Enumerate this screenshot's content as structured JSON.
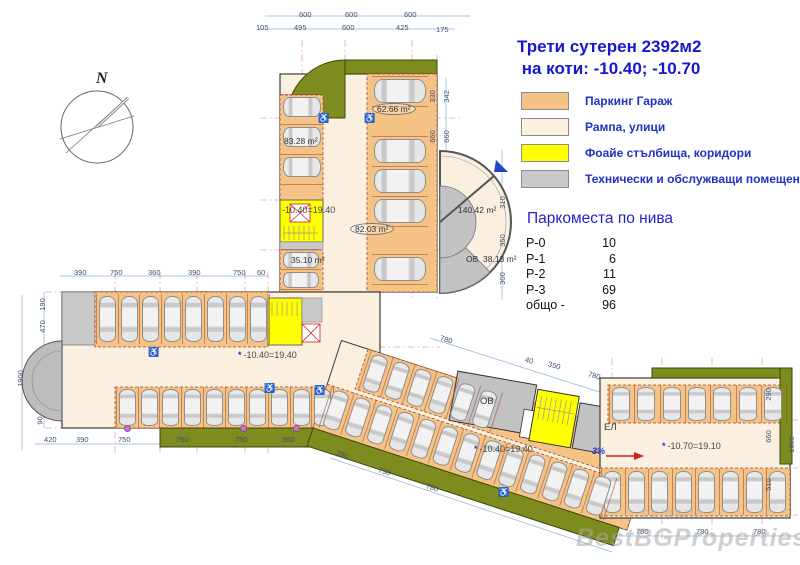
{
  "title": {
    "line1": "Трети сутерен 2392м2",
    "line2": " на коти: -10.40; -10.70"
  },
  "legend": {
    "items": [
      {
        "label": "Паркинг Гараж",
        "color": "#F6C387"
      },
      {
        "label": "Рампа, улици",
        "color": "#FCF1E3"
      },
      {
        "label": "Фоайе стълбища, коридори",
        "color": "#FFFF00"
      },
      {
        "label": "Технически и обслужващи помещения",
        "color": "#C9C9C9"
      }
    ]
  },
  "parking_table": {
    "title": "Паркоместа по нива",
    "rows": [
      {
        "level": "Р-0",
        "count": "10"
      },
      {
        "level": "Р-1",
        "count": "6"
      },
      {
        "level": "Р-2",
        "count": "11"
      },
      {
        "level": "Р-3",
        "count": "69"
      },
      {
        "level": "общо -",
        "count": "96"
      }
    ]
  },
  "compass": {
    "label": "N"
  },
  "plan": {
    "area_labels": {
      "a83": "83.28 m²",
      "a62": "62.66 m²",
      "a82": "82.03 m²",
      "a35": "35.10 m²",
      "a140": "140.42 m²",
      "a38": "38.13 m²"
    },
    "level_labels": {
      "top": "-10.40=19.40",
      "left": "-10.40=19.40",
      "mid": "-10.40=19.40",
      "right": "-10.70=19.10"
    },
    "rooms": {
      "ov_circle": "ОВ",
      "ov_mid": "ОВ",
      "el": "ЕЛ"
    },
    "slope": "3%"
  },
  "dimensions": {
    "top_row1": [
      "600",
      "600",
      "600"
    ],
    "top_row2": [
      "105",
      "495",
      "600",
      "425",
      "175"
    ],
    "vwing_right": [
      "330",
      "342",
      "660",
      "660",
      "310",
      "350",
      "300"
    ],
    "leftwing_top": [
      "390",
      "750",
      "360",
      "390",
      "750",
      "60"
    ],
    "left_side": [
      "190",
      "470",
      "1900",
      "90"
    ],
    "bottom_left": [
      "420",
      "390",
      "750",
      "750",
      "750",
      "360"
    ],
    "diag_top": [
      "780",
      "40",
      "350",
      "780"
    ],
    "diag_bottom": [
      "390",
      "750",
      "780"
    ],
    "right_bottom": [
      "780",
      "780",
      "780"
    ],
    "right_side": [
      "290",
      "660",
      "510",
      "1600"
    ]
  },
  "watermark": {
    "text": "BestBGProperties",
    "subtext": "bulgaria"
  }
}
